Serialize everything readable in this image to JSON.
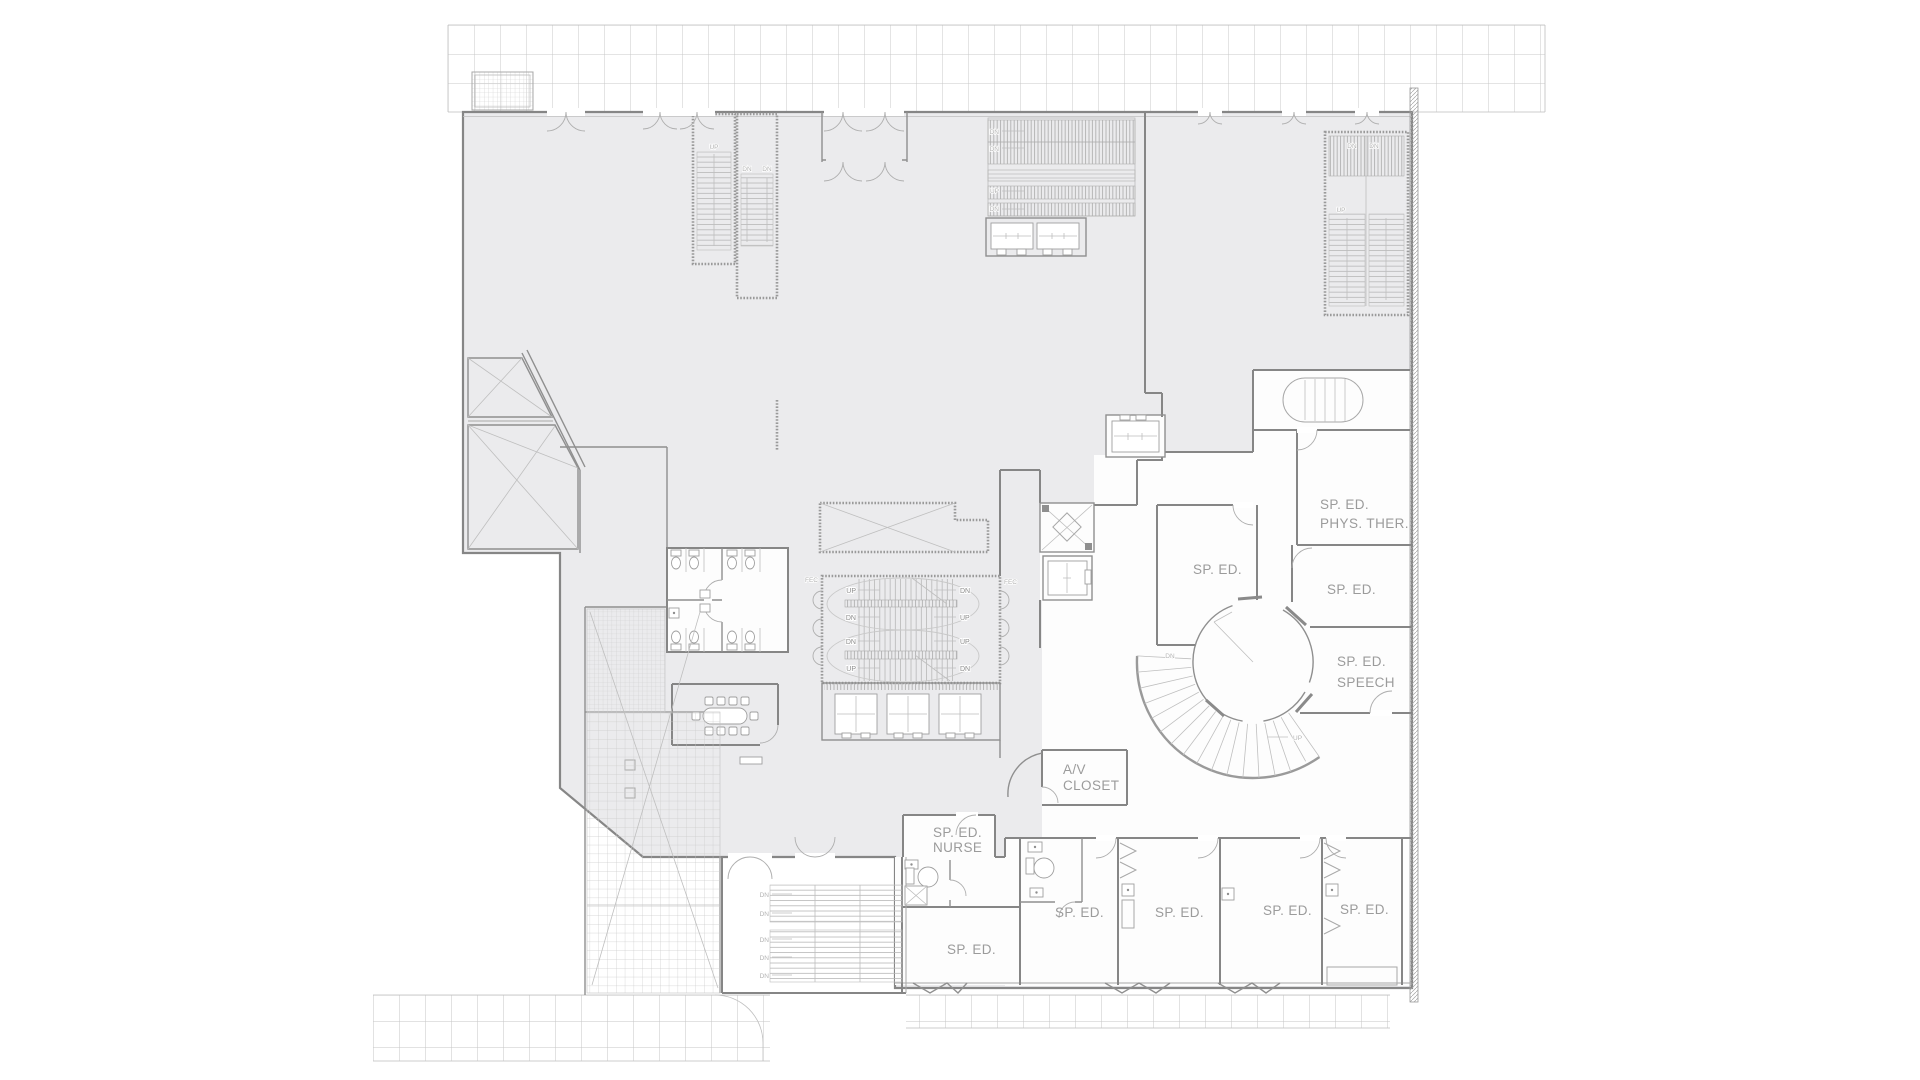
{
  "plan": {
    "room_names": [
      "SP. ED. PHYS. THER.",
      "SP. ED.",
      "SP. ED. SPEECH",
      "SP. ED.",
      "SP. ED. NURSE",
      "A/V CLOSET",
      "SP. ED.",
      "SP. ED.",
      "SP. ED.",
      "SP. ED.",
      "SP. ED."
    ],
    "labels": {
      "sp_ed": "SP. ED.",
      "phys_ther": "PHYS. THER.",
      "speech": "SPEECH",
      "nurse": "NURSE",
      "av": "A/V",
      "closet": "CLOSET"
    },
    "directions": {
      "up": "UP",
      "down": "DN"
    },
    "annotations": {
      "fec": "FEC"
    },
    "colors": {
      "background": "#ffffff",
      "room_fill": "#ebebed",
      "wall": "#868686",
      "detail": "#b5b5b5",
      "grid": "#c9c9c9",
      "label_text": "#9b9b9b"
    }
  }
}
